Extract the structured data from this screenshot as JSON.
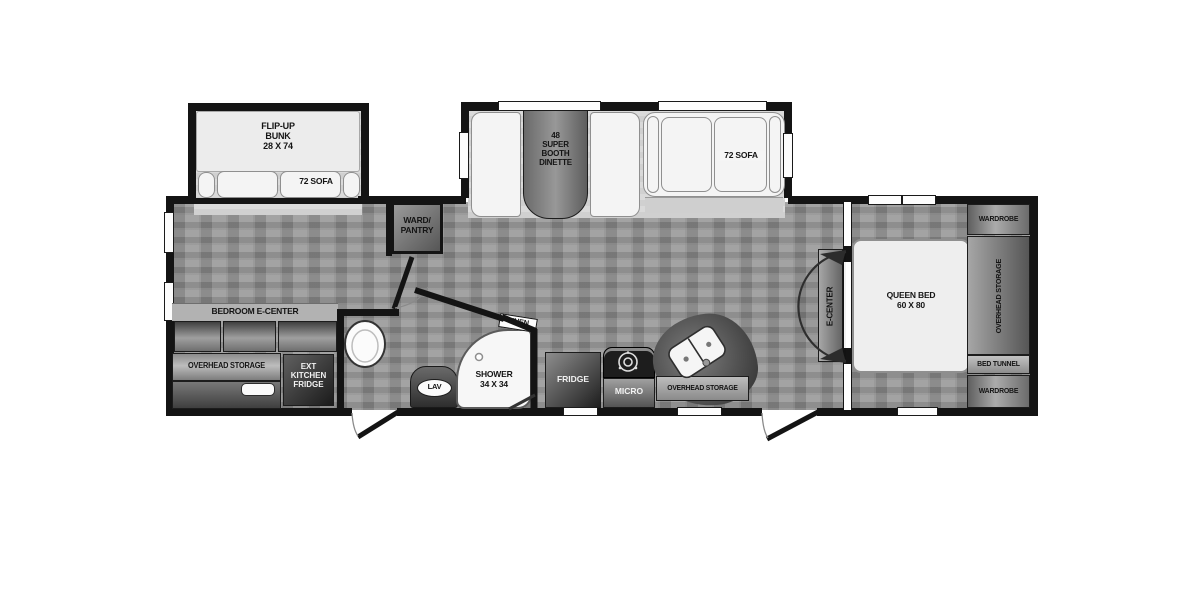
{
  "diagram": "rv-travel-trailer-floor-plan",
  "colors": {
    "wall": "#141414",
    "floor": "#979797",
    "slide_floor": "#d8d8d8",
    "furniture_white": "#f4f4f4",
    "cabinet_dark": "#3a3a3a",
    "cabinet_light": "#ababab",
    "label_text": "#141414",
    "label_text_light": "#f2f2f2"
  },
  "labels": {
    "bunk": [
      "FLIP-UP",
      "BUNK",
      "28 X 74"
    ],
    "bunk_sofa": "72 SOFA",
    "dinette": [
      "48",
      "SUPER",
      "BOOTH",
      "DINETTE"
    ],
    "top_sofa": "72 SOFA",
    "ward_pantry": [
      "WARD/",
      "PANTRY"
    ],
    "bedroom_ecenter": "BEDROOM E-CENTER",
    "overhead_storage_front": "OVERHEAD STORAGE",
    "ext_kitchen_fridge": [
      "EXT",
      "KITCHEN",
      "FRIDGE"
    ],
    "lav": "LAV",
    "shower": [
      "SHOWER",
      "34 X 34"
    ],
    "linen": "LINEN",
    "fridge": "FRIDGE",
    "micro": "MICRO",
    "overhead_storage_kitchen": "OVERHEAD STORAGE",
    "e_center": "E-CENTER",
    "queen_bed": [
      "QUEEN BED",
      "60 X 80"
    ],
    "wardrobe_top": "WARDROBE",
    "overhead_storage_bedroom": "OVERHEAD STORAGE",
    "bed_tunnel": "BED TUNNEL",
    "wardrobe_bottom": "WARDROBE"
  }
}
